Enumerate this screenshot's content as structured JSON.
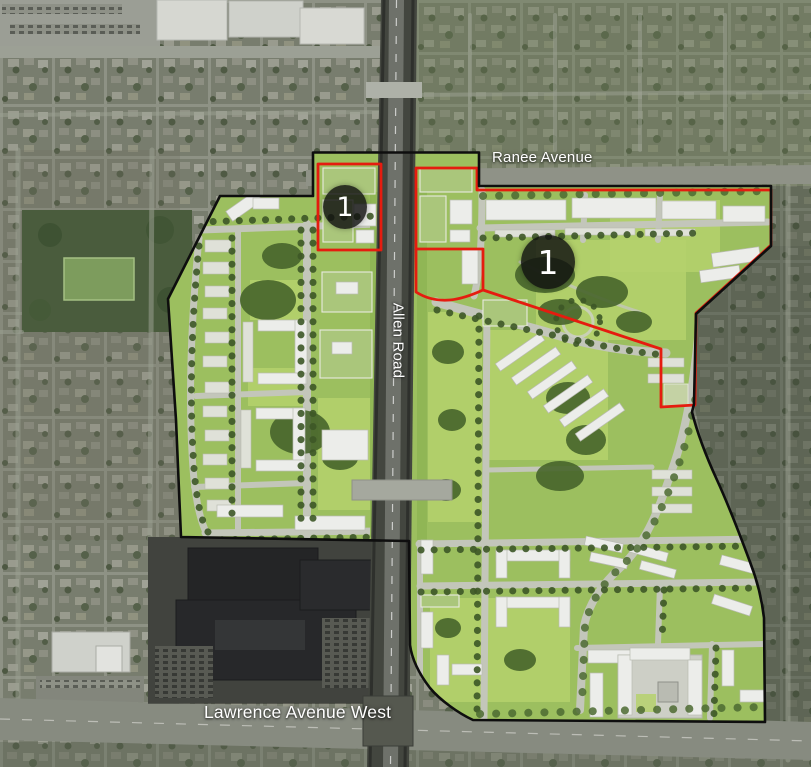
{
  "map": {
    "street_labels": [
      {
        "name": "ranee-avenue",
        "text": "Ranee Avenue"
      },
      {
        "name": "allen-road",
        "text": "Allen Road"
      },
      {
        "name": "lawrence-avenue-west",
        "text": "Lawrence Avenue West"
      }
    ],
    "phase_markers": [
      {
        "label": "1"
      },
      {
        "label": "1"
      }
    ],
    "colors": {
      "phase-red": "#e51c0f",
      "boundary-black": "#0e0e0e",
      "label-white": "#ffffff",
      "marker-bg": "rgba(16,16,16,0.82)"
    }
  }
}
